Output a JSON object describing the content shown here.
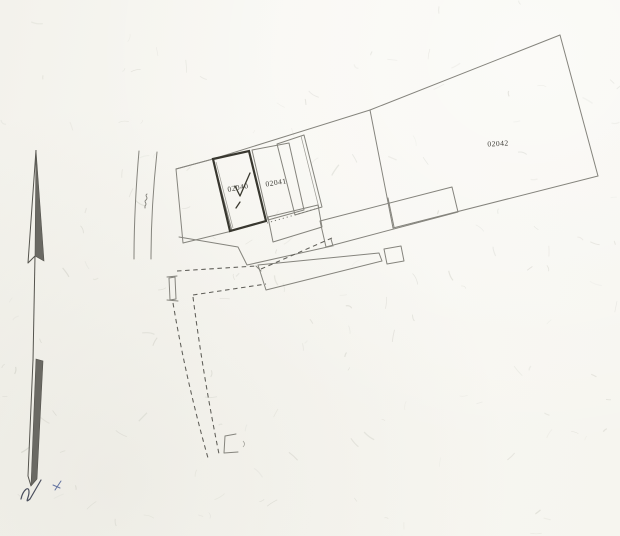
{
  "plan": {
    "kind": "scanned cadastral site plan",
    "parcels": [
      {
        "id": "02040",
        "selected": true,
        "has_checkmark": true
      },
      {
        "id": "02041",
        "selected": false,
        "has_checkmark": false
      },
      {
        "id": "02042",
        "selected": false,
        "has_checkmark": false
      }
    ],
    "north_arrow": {
      "present": true,
      "direction": "up"
    }
  },
  "colors": {
    "paper": "#f7f6f1",
    "line": "#85847d",
    "line_dark": "#5f5e58",
    "bold_outline": "#38372f",
    "label": "#3f3e38",
    "arrow_fill": "#6a6963",
    "handwriting": "#4a4e5c",
    "handwriting_blue": "#6272a0"
  }
}
